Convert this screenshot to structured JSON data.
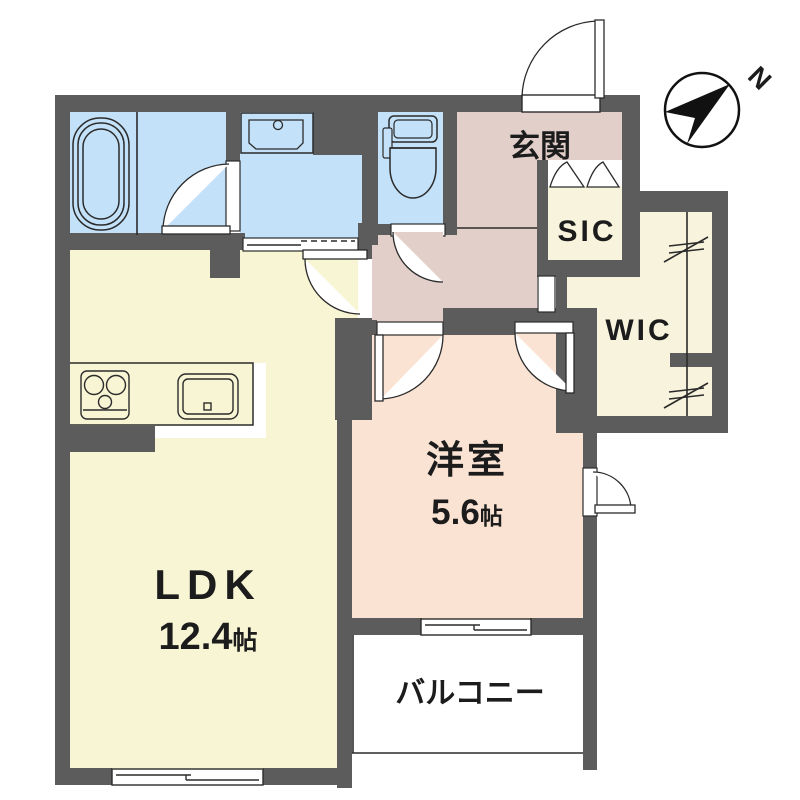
{
  "plan": {
    "type": "apartment-floor-plan",
    "compass": {
      "label": "N"
    },
    "rooms": {
      "ldk": {
        "name": "LDK",
        "size_value": "12.4",
        "size_unit": "帖"
      },
      "bedroom": {
        "name": "洋室",
        "size_value": "5.6",
        "size_unit": "帖"
      },
      "entrance": {
        "name": "玄関"
      },
      "shoe_closet": {
        "name": "SIC"
      },
      "walk_in_closet": {
        "name": "WIC"
      },
      "balcony": {
        "name": "バルコニー"
      }
    },
    "fixtures": [
      "bathtub",
      "washbasin",
      "toilet",
      "stove-2-burner",
      "kitchen-sink",
      "hanger-pipe"
    ],
    "openings": [
      "entrance-door",
      "washroom-door",
      "toilet-door",
      "ldk-door",
      "bedroom-door-west",
      "bedroom-door-east",
      "bedroom-side-door",
      "sic-bifold-door",
      "sanitary-sliding-door",
      "ldk-window",
      "bedroom-window"
    ],
    "colors": {
      "wall": "#5c5c5c",
      "wet_area": "#c3e1f8",
      "ldk": "#f8f5d4",
      "hall": "#e2cfca",
      "bedroom": "#fae3d3",
      "closet": "#f7f3dc",
      "line": "#2b2b2b",
      "paper": "#ffffff"
    }
  }
}
